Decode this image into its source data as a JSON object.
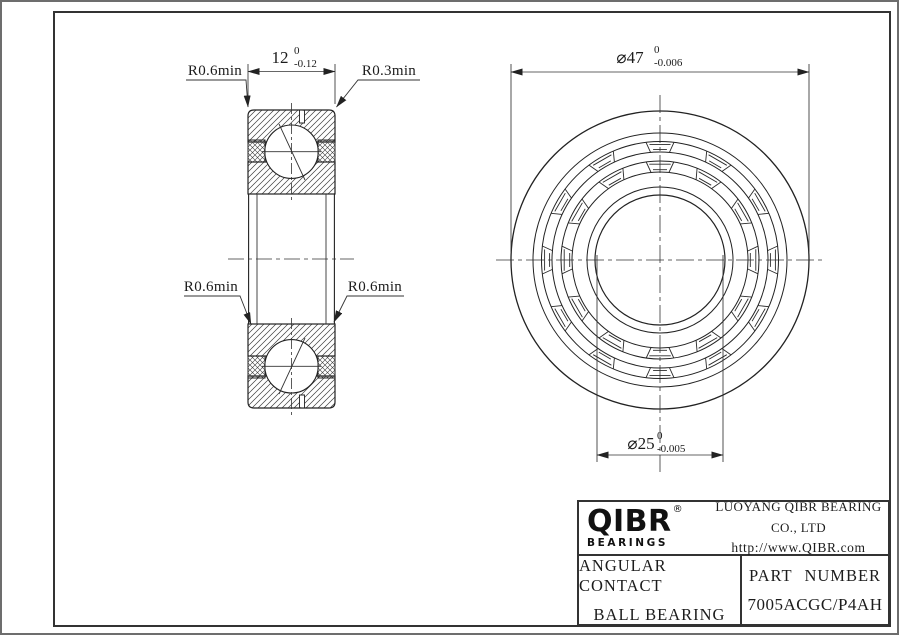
{
  "drawing": {
    "radius_labels": {
      "top_left": "R0.6min",
      "top_right": "R0.3min",
      "bottom_left": "R0.6min",
      "bottom_right": "R0.6min"
    },
    "width_dim": {
      "value": "12",
      "tol_upper": "0",
      "tol_lower": "-0.12"
    },
    "od_dim": {
      "value": "⌀47",
      "tol_upper": "0",
      "tol_lower": "-0.006"
    },
    "bore_dim": {
      "value": "⌀25",
      "tol_upper": "0",
      "tol_lower": "-0.005"
    }
  },
  "title_block": {
    "brand": "QIBR",
    "registered_mark": "®",
    "brand_sub": "BEARINGS",
    "company": "LUOYANG QIBR BEARING CO., LTD",
    "website": "http://www.QIBR.com",
    "product_type_line1": "ANGULAR CONTACT",
    "product_type_line2": "BALL BEARING",
    "part_number_label": "PART NUMBER",
    "part_number": "7005ACGC/P4AH"
  },
  "colors": {
    "line": "#2b2b2b",
    "frame": "#333333",
    "background": "#ffffff"
  }
}
